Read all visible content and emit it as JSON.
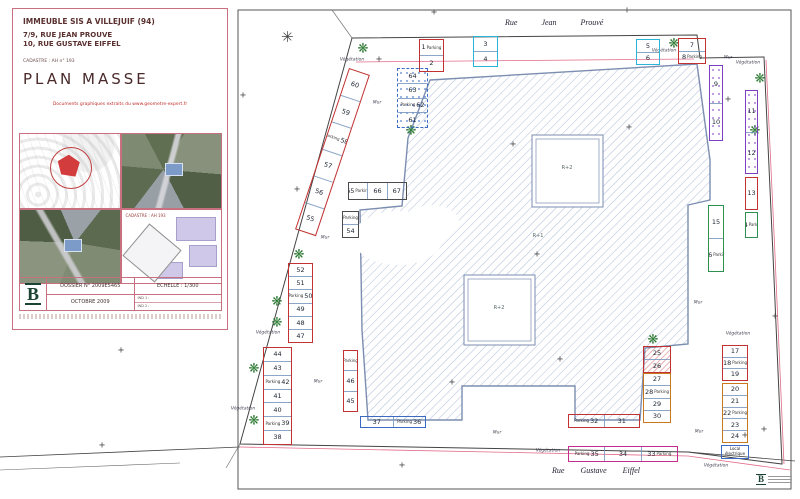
{
  "title_block": {
    "line1": "IMMEUBLE SIS A VILLEJUIF (94)",
    "line2": "7/9, RUE JEAN PROUVE",
    "line3": "10, RUE GUSTAVE EIFFEL",
    "cadastre": "CADASTRE : AH n° 193",
    "title": "PLAN MASSE",
    "docs_note": "Documents graphiques extraits du www.geometre-expert.fr",
    "thumb_caption": "CADASTRE : AH 193",
    "dossier": "DOSSIER N° 2009E5465",
    "echelle": "ECHELLE : 1/300",
    "date": "OCTOBRE 2009",
    "ind1": "IND 1 :",
    "ind2": "IND 2 :",
    "logo_letter": "B"
  },
  "symbols": {
    "tree": "❋",
    "compass": "✳",
    "cross": "+"
  },
  "plan": {
    "streets": {
      "top": "Rue Jean Prouvé",
      "bottom": "Rue Gustave Eiffel"
    },
    "building_labels": [
      {
        "t": "R+2",
        "x": 567,
        "y": 168
      },
      {
        "t": "R+1",
        "x": 538,
        "y": 236
      },
      {
        "t": "R+2",
        "x": 499,
        "y": 308
      }
    ],
    "words": {
      "mur": "Mur",
      "vegetation": "Végétation"
    },
    "parcels": [
      {
        "x": 419,
        "y": 39,
        "w": 25,
        "h": 33,
        "c": "red",
        "cells": [
          {
            "n": "1",
            "t": "Parking"
          },
          {
            "n": "2"
          }
        ]
      },
      {
        "x": 473,
        "y": 36,
        "w": 25,
        "h": 31,
        "c": "cyan",
        "cells": [
          {
            "n": "3"
          },
          {
            "n": "4"
          }
        ]
      },
      {
        "x": 636,
        "y": 39,
        "w": 24,
        "h": 26,
        "c": "cyan",
        "cells": [
          {
            "n": "5"
          },
          {
            "n": "6"
          }
        ]
      },
      {
        "x": 678,
        "y": 38,
        "w": 28,
        "h": 26,
        "c": "red",
        "cells": [
          {
            "n": "7"
          },
          {
            "n": "8",
            "t": "Parking"
          }
        ]
      },
      {
        "x": 709,
        "y": 65,
        "w": 14,
        "h": 76,
        "c": "purple",
        "fx": "fx-dots-p",
        "cells": [
          {
            "n": "9"
          },
          {
            "n": "10"
          }
        ]
      },
      {
        "x": 745,
        "y": 90,
        "w": 13,
        "h": 84,
        "c": "purple",
        "fx": "fx-dots-p",
        "cells": [
          {
            "n": "11"
          },
          {
            "n": "12"
          }
        ]
      },
      {
        "x": 745,
        "y": 177,
        "w": 13,
        "h": 33,
        "c": "red",
        "cells": [
          {
            "n": "13"
          }
        ]
      },
      {
        "x": 745,
        "y": 212,
        "w": 13,
        "h": 26,
        "c": "green",
        "cells": [
          {
            "n": "14",
            "t": "Parking"
          }
        ]
      },
      {
        "x": 708,
        "y": 205,
        "w": 16,
        "h": 67,
        "c": "green",
        "cells": [
          {
            "n": "15"
          },
          {
            "n": "16",
            "t": "Parking"
          }
        ]
      },
      {
        "x": 722,
        "y": 345,
        "w": 26,
        "h": 36,
        "c": "red",
        "cells": [
          {
            "n": "17"
          },
          {
            "n": "18",
            "t": "Parking"
          },
          {
            "n": "19"
          }
        ]
      },
      {
        "x": 722,
        "y": 383,
        "w": 26,
        "h": 60,
        "c": "orange",
        "cells": [
          {
            "n": "20"
          },
          {
            "n": "21"
          },
          {
            "n": "22",
            "t": "Parking"
          },
          {
            "n": "23"
          },
          {
            "n": "24"
          }
        ]
      },
      {
        "x": 721,
        "y": 445,
        "w": 28,
        "h": 14,
        "c": "blue",
        "cells": [
          {
            "lab": "Local électrique"
          }
        ]
      },
      {
        "x": 643,
        "y": 346,
        "w": 28,
        "h": 27,
        "c": "red",
        "fx": "fx-hatch",
        "cells": [
          {
            "n": "25"
          },
          {
            "n": "26"
          }
        ]
      },
      {
        "x": 643,
        "y": 373,
        "w": 28,
        "h": 50,
        "c": "orange",
        "cells": [
          {
            "n": "27"
          },
          {
            "n": "28",
            "t": "Parking"
          },
          {
            "n": "29"
          },
          {
            "n": "30"
          }
        ]
      },
      {
        "x": 568,
        "y": 414,
        "w": 72,
        "h": 14,
        "c": "red",
        "dir": "h",
        "bold": 1,
        "cells": [
          {
            "n": "32",
            "t": "Parking",
            "tp": "l"
          },
          {
            "n": "31"
          }
        ]
      },
      {
        "x": 360,
        "y": 416,
        "w": 66,
        "h": 12,
        "c": "blue",
        "dir": "h",
        "cells": [
          {
            "n": "37"
          },
          {
            "n": "36",
            "t": "Parking",
            "tp": "l"
          }
        ]
      },
      {
        "x": 568,
        "y": 446,
        "w": 110,
        "h": 16,
        "c": "magenta",
        "dir": "h",
        "bold": 1,
        "cells": [
          {
            "n": "35",
            "t": "Parking",
            "tp": "l"
          },
          {
            "n": "34"
          },
          {
            "n": "33",
            "t": "Parking"
          }
        ]
      },
      {
        "x": 263,
        "y": 347,
        "w": 29,
        "h": 98,
        "c": "red",
        "cells": [
          {
            "n": "44"
          },
          {
            "n": "43"
          },
          {
            "n": "42",
            "t": "Parking",
            "tp": "l"
          },
          {
            "n": "41"
          },
          {
            "n": "40"
          },
          {
            "n": "39",
            "t": "Parking",
            "tp": "l"
          },
          {
            "n": "38"
          }
        ]
      },
      {
        "x": 288,
        "y": 263,
        "w": 25,
        "h": 80,
        "c": "red",
        "cells": [
          {
            "n": "52"
          },
          {
            "n": "51"
          },
          {
            "n": "50",
            "t": "Parking",
            "tp": "l"
          },
          {
            "n": "49"
          },
          {
            "n": "48"
          },
          {
            "n": "47"
          }
        ]
      },
      {
        "x": 343,
        "y": 350,
        "w": 15,
        "h": 62,
        "c": "red",
        "cells": [
          {
            "t": "Parking"
          },
          {
            "n": "46"
          },
          {
            "n": "45"
          }
        ]
      },
      {
        "x": 349,
        "y": 68,
        "w": 22,
        "h": 170,
        "c": "red",
        "rot": 18.5,
        "cells": [
          {
            "n": "60"
          },
          {
            "n": "59"
          },
          {
            "n": "58",
            "t": "Parking",
            "tp": "l"
          },
          {
            "n": "57"
          },
          {
            "n": "56"
          },
          {
            "n": "55"
          }
        ]
      },
      {
        "x": 397,
        "y": 68,
        "w": 31,
        "h": 60,
        "c": "blue",
        "fx": "fx-dots-b fx-dash",
        "cells": [
          {
            "n": "64"
          },
          {
            "n": "63"
          },
          {
            "n": "62",
            "t": "Parking",
            "tp": "l"
          },
          {
            "n": "61"
          }
        ]
      },
      {
        "x": 348,
        "y": 182,
        "w": 59,
        "h": 18,
        "c": "black",
        "dir": "h",
        "cells": [
          {
            "n": "65",
            "t": "Parking"
          },
          {
            "n": "66"
          },
          {
            "n": "67"
          }
        ]
      },
      {
        "x": 342,
        "y": 211,
        "w": 17,
        "h": 27,
        "c": "black",
        "cells": [
          {
            "t": "Parking"
          },
          {
            "n": "54"
          }
        ]
      }
    ],
    "trees": [
      [
        363,
        49
      ],
      [
        674,
        44
      ],
      [
        760,
        79
      ],
      [
        755,
        131
      ],
      [
        411,
        131
      ],
      [
        653,
        340
      ],
      [
        299,
        255
      ],
      [
        277,
        302
      ],
      [
        277,
        323
      ],
      [
        254,
        369
      ],
      [
        254,
        421
      ]
    ],
    "crosses": [
      [
        379,
        60
      ],
      [
        297,
        190
      ],
      [
        513,
        145
      ],
      [
        537,
        255
      ],
      [
        560,
        360
      ],
      [
        452,
        383
      ],
      [
        629,
        128
      ],
      [
        728,
        100
      ],
      [
        775,
        317
      ],
      [
        764,
        430
      ],
      [
        121,
        351
      ],
      [
        102,
        446
      ],
      [
        402,
        466
      ],
      [
        745,
        436
      ],
      [
        434,
        13
      ],
      [
        627,
        11
      ],
      [
        243,
        96
      ]
    ],
    "mur_labels": [
      [
        377,
        103
      ],
      [
        325,
        238
      ],
      [
        318,
        382
      ],
      [
        497,
        433
      ],
      [
        698,
        303
      ],
      [
        699,
        432
      ],
      [
        728,
        58
      ]
    ],
    "veg_labels": [
      [
        352,
        60
      ],
      [
        664,
        51
      ],
      [
        748,
        63
      ],
      [
        268,
        333
      ],
      [
        243,
        409
      ],
      [
        738,
        334
      ],
      [
        716,
        466
      ],
      [
        548,
        451
      ]
    ]
  }
}
